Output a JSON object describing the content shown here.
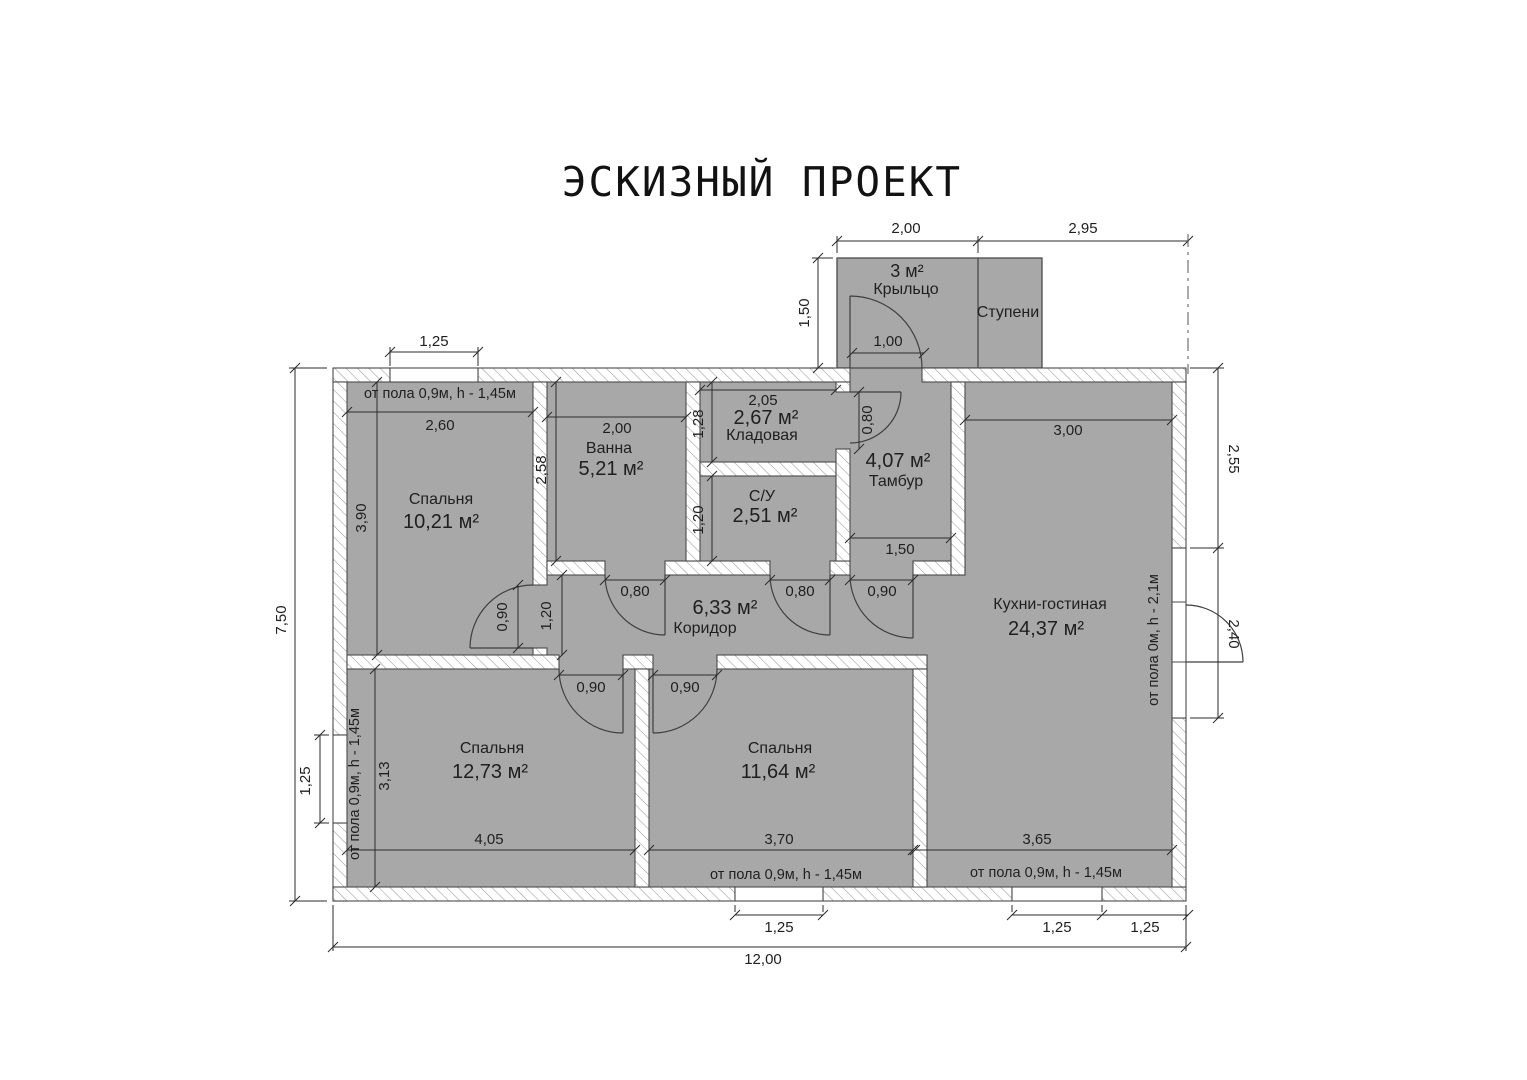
{
  "title": "ЭСКИЗНЫЙ ПРОЕКТ",
  "colors": {
    "room_fill": "#a8a8a8",
    "wall_line": "#4a4a4a",
    "text_color": "#1f1f1f"
  },
  "porch": {
    "area": "3 м²",
    "name": "Крыльцо",
    "steps": "Ступени"
  },
  "rooms": {
    "bedroom1": {
      "name": "Спальня",
      "area": "10,21 м²"
    },
    "bath": {
      "name": "Ванна",
      "area": "5,21 м²"
    },
    "storage": {
      "name": "Кладовая",
      "area": "2,67 м²"
    },
    "wc": {
      "name": "С/У",
      "area": "2,51 м²"
    },
    "tambour": {
      "name": "Тамбур",
      "area": "4,07 м²"
    },
    "corridor": {
      "name": "Коридор",
      "area": "6,33 м²"
    },
    "kitchen": {
      "name": "Кухни-гостиная",
      "area": "24,37 м²"
    },
    "bedroom2": {
      "name": "Спальня",
      "area": "12,73 м²"
    },
    "bedroom3": {
      "name": "Спальня",
      "area": "11,64 м²"
    }
  },
  "notes": {
    "window_sill": "от пола 0,9м, h - 1,45м",
    "terrace_door": "от пола 0м, h - 2,1м"
  },
  "dims": {
    "porch_width": "2,00",
    "porch_side": "2,95",
    "porch_depth": "1,50",
    "porch_door": "1,00",
    "top_window": "1,25",
    "total_height": "7,50",
    "total_width": "12,00",
    "left_window": "1,25",
    "b1_width": "2,60",
    "b1_height": "3,90",
    "b1_door": "0,90",
    "bath_width": "2,00",
    "bath_height": "2,58",
    "storage_width": "2,05",
    "storage_height": "1,28",
    "storage_door": "0,80",
    "wc_height": "1,20",
    "wc_door": "0,80",
    "bath_door": "0,80",
    "tambour_width": "1,50",
    "tambour_door": "0,90",
    "corridor_height": "1,20",
    "kitchen_width": "3,00",
    "right_upper": "2,55",
    "right_door": "2,40",
    "b2_width": "4,05",
    "b2_height": "3,13",
    "b2_door": "0,90",
    "b3_width": "3,70",
    "b3_door": "0,90",
    "kitchen_bottom": "3,65",
    "bottom_window": "1,25",
    "kitchen_window": "1,25",
    "corner_offset": "1,25"
  }
}
